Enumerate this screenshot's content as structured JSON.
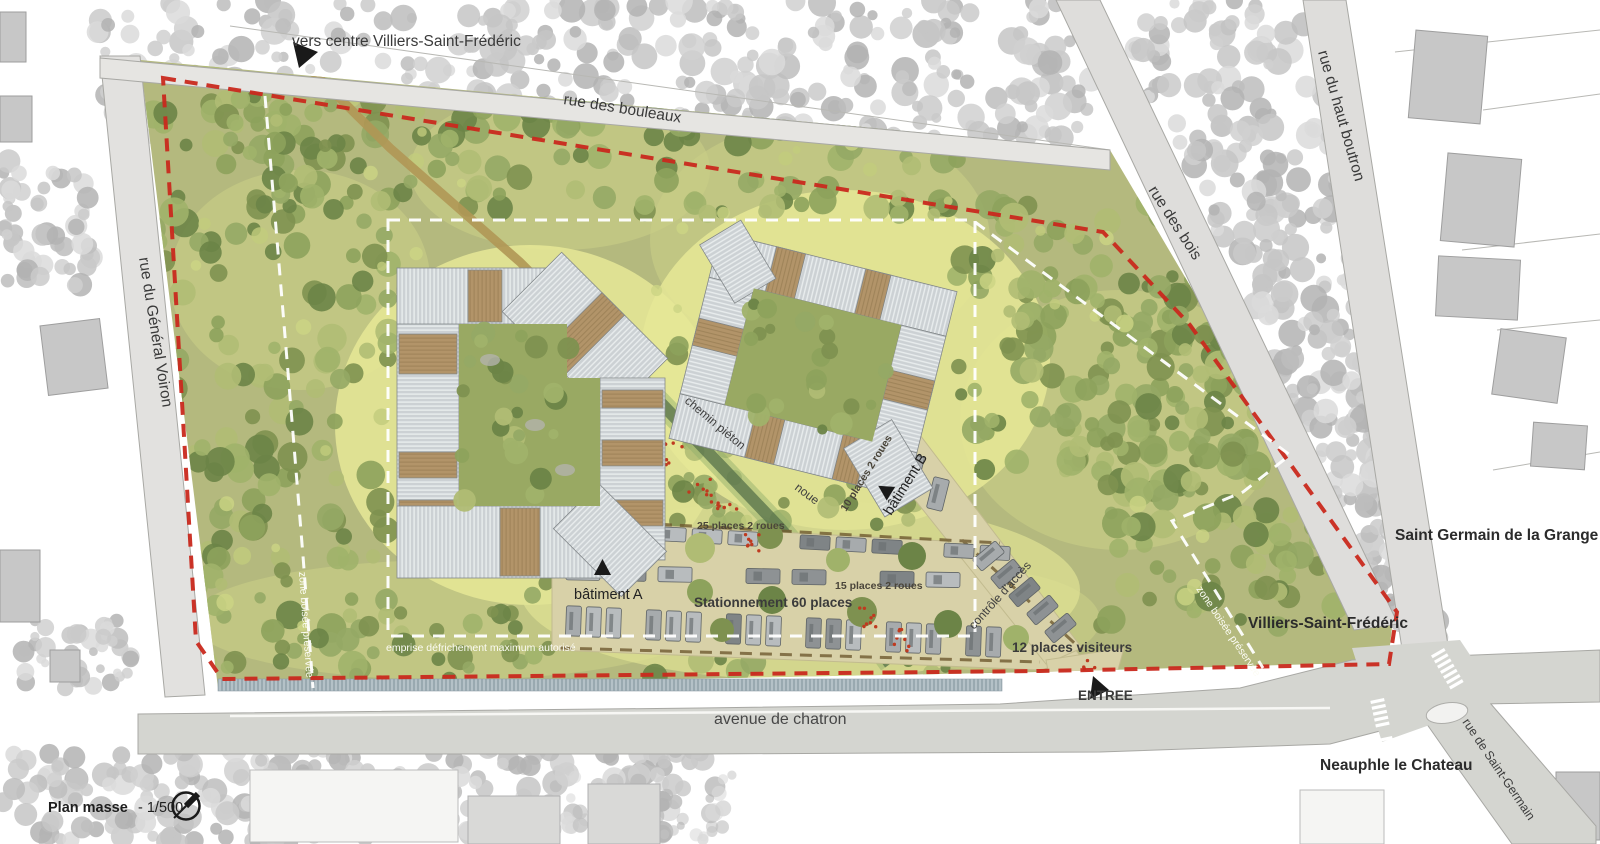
{
  "title": {
    "plan_masse": "Plan masse",
    "echelle": "- 1/500"
  },
  "labels": {
    "vers_centre": "vers centre Villiers-Saint-Frédéric",
    "rue_des_bouleaux": "rue des bouleaux",
    "rue_du_haut_boutron": "rue du haut boutron",
    "rue_des_bois": "rue des bois",
    "rue_du_general_voiron": "rue du Général Voiron",
    "avenue_de_chatron": "avenue de chatron",
    "rue_de_saint_germain": "rue de Saint-Germain",
    "saint_germain_de_la_grange": "Saint Germain de la Grange",
    "villiers_saint_frederic": "Villiers-Saint-Frédéric",
    "neauphle_le_chateau": "Neauphle le Chateau",
    "batiment_a": "bâtiment A",
    "batiment_b": "bâtiment B",
    "stationnement": "Stationnement 60 places",
    "places_25": "25 places 2 roues",
    "places_15": "15 places 2 roues",
    "places_10": "10 places 2 roues",
    "controle_acces": "contrôle d'accès",
    "places_visiteurs": "12 places visiteurs",
    "entree": "ENTREE",
    "chemin_pieton": "chemin piéton",
    "noue": "noue",
    "zone_boisee_1": "zone boisée préservée",
    "zone_boisee_2": "zone boisée préservée",
    "emprise": "emprise défrichement maximum autorisé"
  },
  "colors": {
    "boundary_red": "#c9291d",
    "clearing_dash_white": "#ffffff",
    "site_green": "#b4b97e",
    "road_gray": "#dedddb",
    "roof_gray": "#ccd1d4",
    "wood_brown": "#b29469",
    "parking_tan": "#d8d1a8"
  }
}
